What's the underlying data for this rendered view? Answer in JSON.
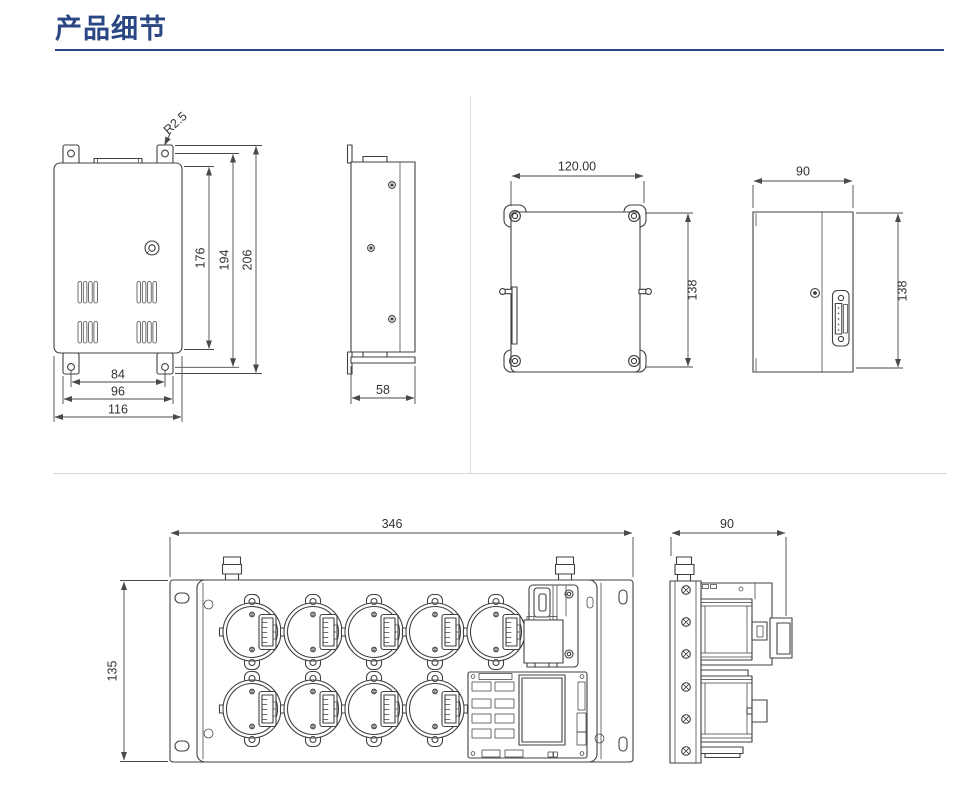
{
  "page": {
    "title": "产品细节"
  },
  "colors": {
    "accent": "#2a4784",
    "drawing_line": "#404040",
    "divider": "#d8d8d8"
  },
  "views": {
    "front": {
      "radius_label": "R2.5",
      "height_inner": "176",
      "height_holes": "194",
      "height_overall": "206",
      "width_holes": "84",
      "width_tabs": "96",
      "width_overall": "116"
    },
    "side": {
      "depth": "58"
    },
    "rear": {
      "width": "120.00",
      "height": "138"
    },
    "right_side": {
      "depth": "90",
      "height": "138"
    },
    "panel_front": {
      "width": "346",
      "height": "135"
    },
    "panel_side": {
      "depth": "90"
    }
  }
}
